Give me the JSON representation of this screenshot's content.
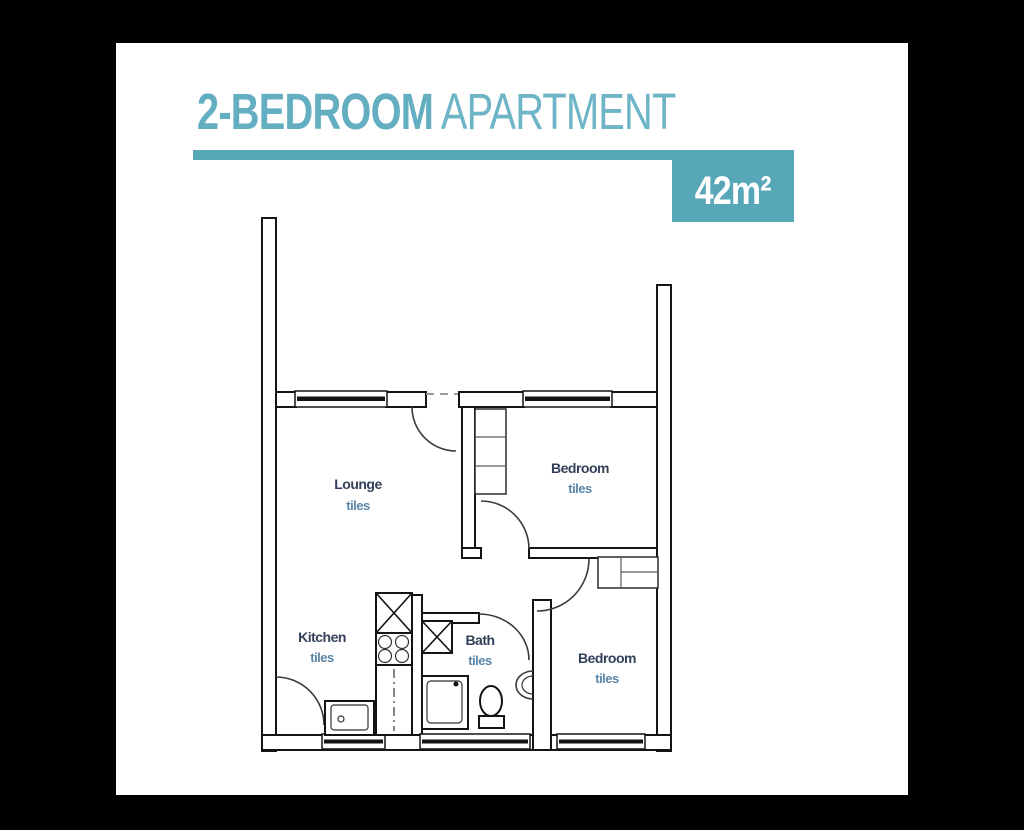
{
  "header": {
    "title_primary": "2-BEDROOM",
    "title_secondary": "APARTMENT",
    "area_badge": "42m²",
    "accent_color": "#58a7b8",
    "title_primary_color": "#64aec1",
    "title_secondary_color": "#6db4c6",
    "badge_text_color": "#ffffff"
  },
  "floorplan": {
    "label_color": "#32405a",
    "finish_color": "#5d87a8",
    "wall_color": "#141414",
    "rooms": [
      {
        "name": "Lounge",
        "finish": "tiles"
      },
      {
        "name": "Bedroom",
        "finish": "tiles"
      },
      {
        "name": "Kitchen",
        "finish": "tiles"
      },
      {
        "name": "Bath",
        "finish": "tiles"
      },
      {
        "name": "Bedroom",
        "finish": "tiles"
      }
    ]
  }
}
